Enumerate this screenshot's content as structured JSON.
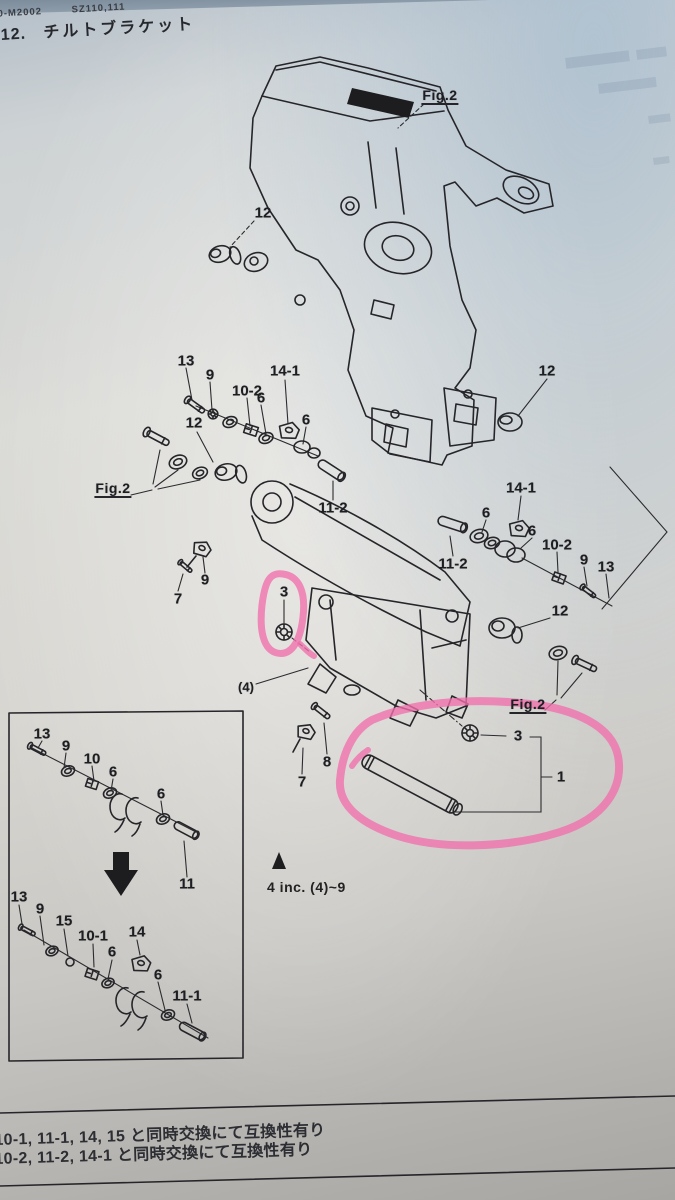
{
  "photo": {
    "paper_color": "#d8d7d3",
    "ink_color": "#26262a",
    "highlight_color": "#f170ad",
    "top_band_color": "#7e8e9c"
  },
  "page": {
    "header": {
      "doc_code": "10-M2002",
      "model_code": "SZ110,111",
      "section_number": "12.",
      "section_title": "チルトブラケット"
    },
    "footnotes": [
      "10-1, 11-1, 14, 15 と同時交換にて互換性有り",
      "10-2, 11-2, 14-1 と同時交換にて互換性有り"
    ]
  },
  "figure": {
    "note": {
      "marker_icon": "triangle-up-marker",
      "text": "4 inc. (4)~9"
    },
    "highlights": [
      "small oval around part 3 nut",
      "large loop around rod part 1 and nut 3"
    ],
    "labels": [
      {
        "t": "Fig.2",
        "x": 440,
        "y": 96,
        "u": 1
      },
      {
        "t": "12",
        "x": 263,
        "y": 213
      },
      {
        "t": "13",
        "x": 186,
        "y": 361
      },
      {
        "t": "9",
        "x": 210,
        "y": 375
      },
      {
        "t": "10-2",
        "x": 247,
        "y": 391
      },
      {
        "t": "14-1",
        "x": 285,
        "y": 371
      },
      {
        "t": "6",
        "x": 261,
        "y": 398
      },
      {
        "t": "6",
        "x": 306,
        "y": 420
      },
      {
        "t": "12",
        "x": 194,
        "y": 423
      },
      {
        "t": "Fig.2",
        "x": 113,
        "y": 489,
        "u": 1
      },
      {
        "t": "11-2",
        "x": 333,
        "y": 508
      },
      {
        "t": "9",
        "x": 205,
        "y": 580
      },
      {
        "t": "7",
        "x": 178,
        "y": 599
      },
      {
        "t": "3",
        "x": 284,
        "y": 592
      },
      {
        "t": "12",
        "x": 547,
        "y": 371
      },
      {
        "t": "14-1",
        "x": 521,
        "y": 488
      },
      {
        "t": "6",
        "x": 486,
        "y": 513
      },
      {
        "t": "6",
        "x": 532,
        "y": 531
      },
      {
        "t": "10-2",
        "x": 557,
        "y": 545
      },
      {
        "t": "9",
        "x": 584,
        "y": 560
      },
      {
        "t": "13",
        "x": 606,
        "y": 567
      },
      {
        "t": "11-2",
        "x": 453,
        "y": 564
      },
      {
        "t": "12",
        "x": 560,
        "y": 611
      },
      {
        "t": "Fig.2",
        "x": 528,
        "y": 705,
        "u": 1
      },
      {
        "t": "(4)",
        "x": 246,
        "y": 687,
        "s": 13
      },
      {
        "t": "8",
        "x": 327,
        "y": 762
      },
      {
        "t": "7",
        "x": 302,
        "y": 782
      },
      {
        "t": "3",
        "x": 518,
        "y": 736
      },
      {
        "t": "1",
        "x": 561,
        "y": 777
      }
    ]
  },
  "inset": {
    "arrow_icon": "down-block-arrow",
    "labels": [
      {
        "t": "13",
        "x": 42,
        "y": 734
      },
      {
        "t": "9",
        "x": 66,
        "y": 746
      },
      {
        "t": "10",
        "x": 92,
        "y": 759
      },
      {
        "t": "6",
        "x": 113,
        "y": 772
      },
      {
        "t": "6",
        "x": 161,
        "y": 794
      },
      {
        "t": "11",
        "x": 187,
        "y": 884
      },
      {
        "t": "13",
        "x": 19,
        "y": 897
      },
      {
        "t": "9",
        "x": 40,
        "y": 909
      },
      {
        "t": "15",
        "x": 64,
        "y": 921
      },
      {
        "t": "10-1",
        "x": 93,
        "y": 936
      },
      {
        "t": "14",
        "x": 137,
        "y": 932
      },
      {
        "t": "6",
        "x": 112,
        "y": 952
      },
      {
        "t": "6",
        "x": 158,
        "y": 975
      },
      {
        "t": "11-1",
        "x": 187,
        "y": 996
      }
    ]
  }
}
